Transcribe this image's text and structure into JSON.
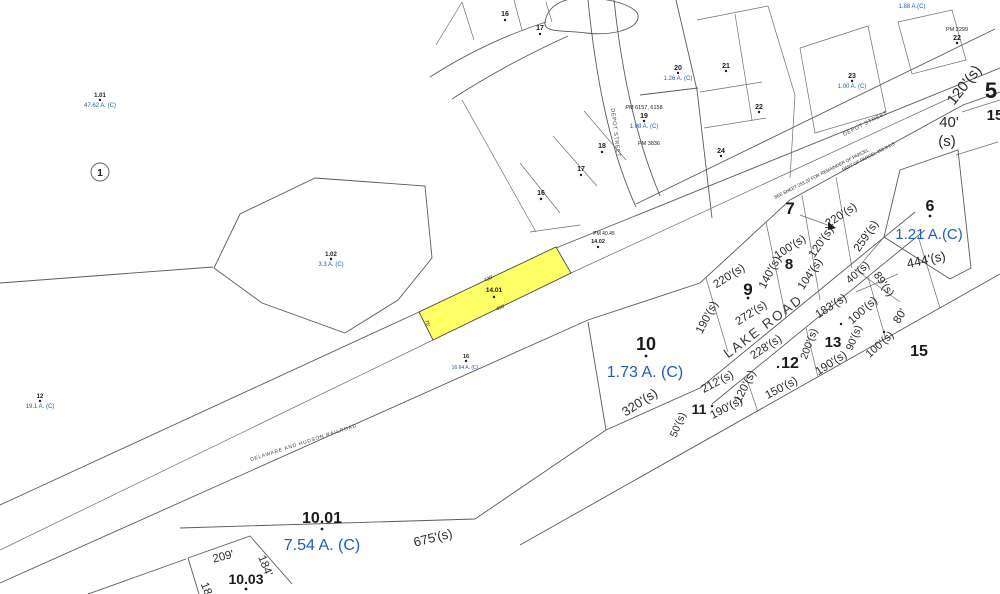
{
  "map": {
    "colors": {
      "background": "#ffffff",
      "lines": "#5a5a5a",
      "text": "#1a1a1a",
      "acreage": "#1b5bc7",
      "highlight_fill": "#ffff66"
    },
    "highlight": {
      "parcel_number": "14.01"
    },
    "roads": {
      "lake_road": "LAKE ROAD",
      "depot_street_v": "DEPOT STREET",
      "depot_street_d": "DEPOT STREET",
      "railroad": "DELAWARE AND HUDSON RAILROAD",
      "note_see_sheet": "SEE SHEET 253.20 FOR REMAINDER OF PARCEL",
      "note_part_of": "PART OF PARCEL 253.3-1-5"
    },
    "parcels": {
      "n1": "1",
      "n1_01": "1.01",
      "a1_01": "47.62 A. (C)",
      "n1_02": "1.02",
      "a1_02": "3.3 A. (C)",
      "n12w": "12",
      "a12w": "19.1 A. (C)",
      "n16a": "16",
      "n17a": "17",
      "n16b": "16",
      "n17b": "17",
      "n18": "18",
      "n19": "19",
      "a19": "1.08 A. (C)",
      "pm19a": "PM 6157, 6158",
      "pm19b": "PM 3836",
      "n20": "20",
      "a20": "1.26 A. (C)",
      "n21": "21",
      "n22a": "22",
      "n24": "24",
      "n23": "23",
      "a23": "1.00 A. (C)",
      "n22b": "22",
      "pm22b": "PM 2299",
      "a25": "1.88 A.(C)",
      "n5": "5",
      "n15r": "15",
      "n6": "6",
      "a6": "1.21 A.(C)",
      "n7": "7",
      "n8": "8",
      "n9": "9",
      "n10": "10",
      "a10": "1.73 A. (C)",
      "n11": "11",
      "n12": "12",
      "n13": "13",
      "n15": "15",
      "n14_01": "14.01",
      "n14_02": "14.02",
      "pm14_02": "PM 40.45",
      "n16rr": "16",
      "a16rr": "16.64 A. (C)",
      "n10_01": "10.01",
      "a10_01": "7.54 A. (C)",
      "n10_03": "10.03"
    },
    "dimensions": {
      "d220a": "220'(s)",
      "d259": "259'(s)",
      "d120a": "120'(s)",
      "d100a": "100'(s)",
      "d140": "140'(s)",
      "d104": "104'(s)",
      "d220b": "220'(s)",
      "d190a": "190'(s)",
      "d272": "272'(s)",
      "d40a": "40'(s)",
      "d183": "183'(s)",
      "d100b": "100'(s)",
      "d80": "80'",
      "d90": "90'(s)",
      "d100c": "100'(s)",
      "d200": "200'(s)",
      "d228": "228'(s)",
      "d190b": "190'(s)",
      "d150": "150'(s)",
      "d120b": "120'(s)",
      "d212": "212'(s)",
      "d190c": "190'(s)",
      "d50": "50'(s)",
      "d320": "320'(s)",
      "d444": "444'(s)",
      "d89": "89'(s)",
      "d120r": "120'(s)",
      "d40r_a": "40'",
      "d40r_b": "(s)",
      "d675": "675'(s)",
      "d209": "209'",
      "d184": "184'",
      "d18x": "18",
      "d430": "430'",
      "d400": "400'",
      "d75": "75'"
    }
  }
}
